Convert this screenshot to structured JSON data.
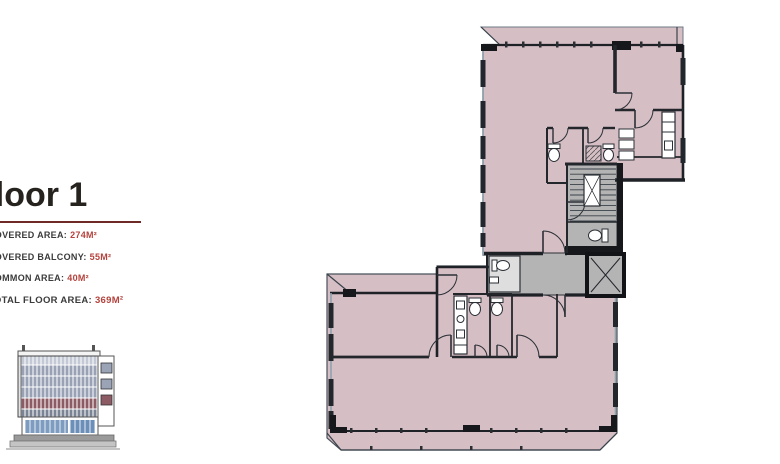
{
  "panel": {
    "title": "Floor 1",
    "underline_color": "#6d2a27",
    "label_color": "#3b3b3b",
    "value_color": "#b5423c",
    "stats": [
      {
        "label": "COVERED AREA:",
        "value": "274m²"
      },
      {
        "label": "COVERED BALCONY:",
        "value": "55m²"
      },
      {
        "label": "COMMON AREA:",
        "value": "40m²"
      },
      {
        "label": "TOTAL FLOOR AREA:",
        "value": "369m²"
      }
    ]
  },
  "elevation": {
    "name": "building-front-elevation",
    "accent_floor_color": "#8d5b64",
    "glass_color": "#7d9cc0",
    "facade_color": "#98a2b4"
  },
  "plan": {
    "name": "floor-1-plan",
    "colors": {
      "floor": "#d5bec4",
      "common_area": "#b4b4b4",
      "wall": "#1e2227",
      "wall_light": "#8fa3ad",
      "window": "#22272d"
    },
    "elements": [
      "balcony",
      "staircase",
      "elevator",
      "corridor",
      "wc",
      "kitchenette",
      "closet",
      "shower"
    ]
  }
}
